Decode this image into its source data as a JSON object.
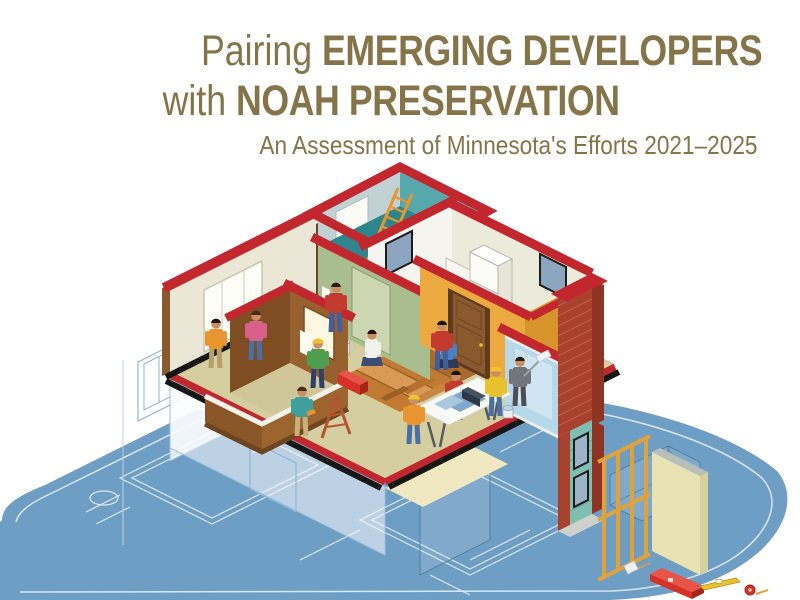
{
  "page": {
    "background": "#ffffff",
    "width": 800,
    "height": 600
  },
  "title": {
    "line1_light": "Pairing",
    "line1_bold": "EMERGING DEVELOPERS",
    "line2_light": "with",
    "line2_bold": "NOAH PRESERVATION",
    "subtitle": "An Assessment of Minnesota's Efforts 2021–2025",
    "text_color": "#867449"
  },
  "illustration": {
    "alt": "Isometric cutaway of a multifamily home being renovated by construction workers, resting on an architect's blueprint floor plan",
    "palette": {
      "wall_cap_red": "#c1272d",
      "blueprint_blue": "#6f9ec4",
      "plan_line_white": "#e9f1f8",
      "teal_room": "#2e858d",
      "cream_wall": "#ebe7d6",
      "green_wall": "#a9bd8e",
      "orange_wall": "#eca93f",
      "floor_olive": "#d4cea0",
      "wood_floor": "#c07a33",
      "brick_red": "#a8422f",
      "siding_teal": "#7fbfb2",
      "door_brown": "#8a5a2e",
      "ladder_orange": "#e8962e",
      "hardhat_yellow": "#f2c12e",
      "toolbox_red": "#d63127",
      "base_black": "#161616"
    },
    "workers": [
      "installing window",
      "installing window",
      "hanging wallpaper",
      "wiring on balcony",
      "laying wood flooring",
      "laying wood flooring",
      "using drill",
      "reviewing blueprints at sawhorse table",
      "reviewing blueprints",
      "site supervisor",
      "painting wall",
      "installing door"
    ],
    "props": [
      "extension ladder",
      "step ladder",
      "sawhorse table with blueprints",
      "toolbox",
      "paint bucket",
      "wood planks",
      "stud wall frame",
      "drywall panel",
      "mallet",
      "toolbox",
      "level",
      "tape measure"
    ]
  }
}
